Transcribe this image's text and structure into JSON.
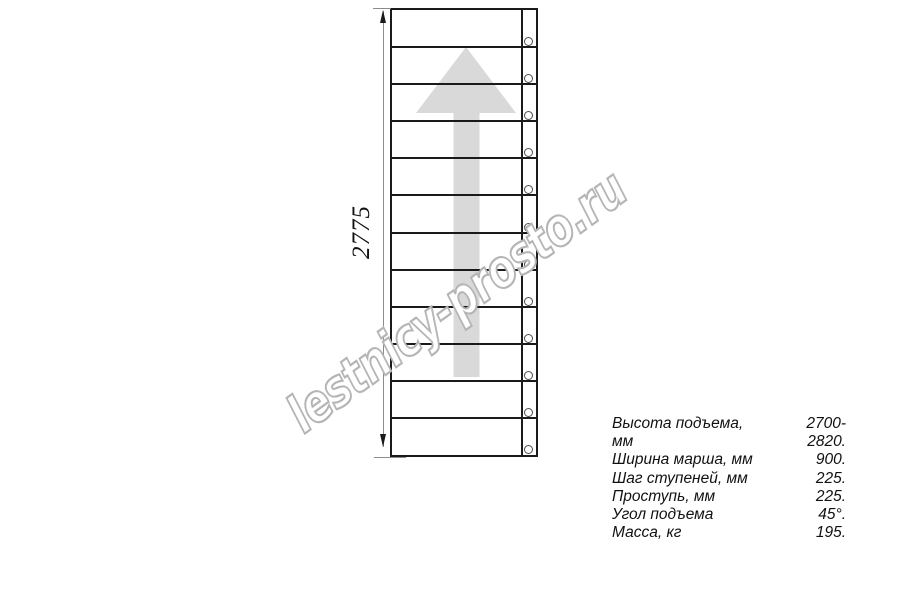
{
  "diagram": {
    "dimension_label": "2775",
    "steps_count": 12,
    "arrow_direction": "up"
  },
  "watermark": "lestnicy-prosto.ru",
  "specs": [
    {
      "label": "Высота подъема, мм",
      "value": "2700-2820."
    },
    {
      "label": "Ширина марша, мм",
      "value": "900."
    },
    {
      "label": "Шаг ступеней, мм",
      "value": "225."
    },
    {
      "label": "Проступь, мм",
      "value": "225."
    },
    {
      "label": "Угол подъема",
      "value": "45°."
    },
    {
      "label": "Масса, кг",
      "value": "195."
    }
  ],
  "colors": {
    "line": "#1a1a1a",
    "dimension": "#8c8c8c",
    "arrow_fill": "#d9d9d9",
    "watermark_stroke": "#b5b5b5",
    "text": "#111111",
    "fastener": "#4d4d4d"
  }
}
